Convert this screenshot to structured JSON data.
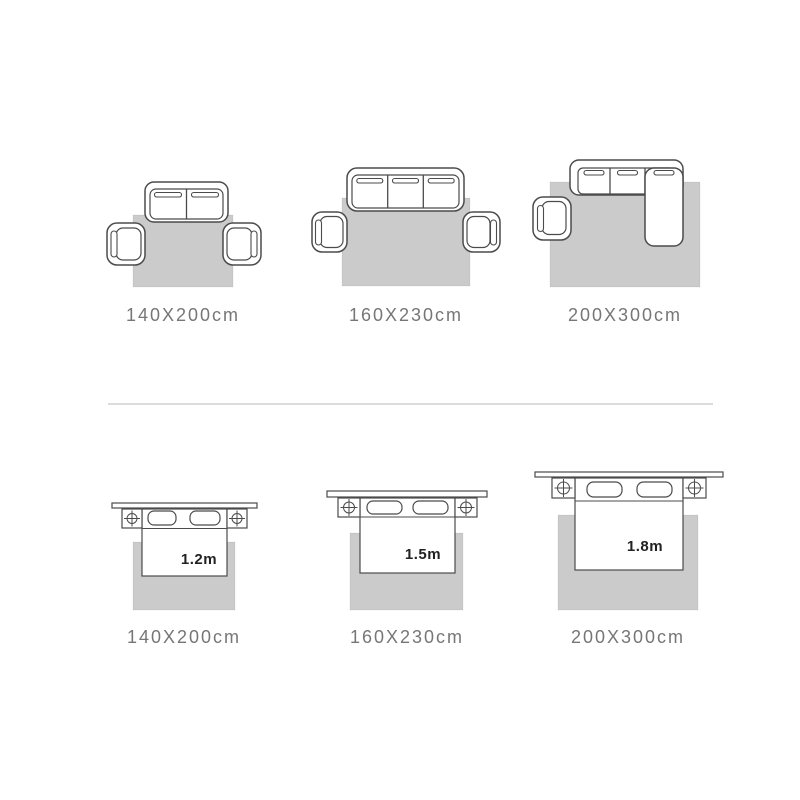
{
  "colors": {
    "rug_fill": "#cbcbcb",
    "furniture_outline": "#4b4b4b",
    "label_text": "#767676",
    "bed_size_text": "#222222",
    "divider": "#dcdcdc",
    "background": "#ffffff"
  },
  "rows": [
    {
      "name": "living-room-rug-sizes",
      "figures": [
        {
          "furniture": "two-seat-sofa-with-two-armchairs",
          "rug_size": "140X200cm"
        },
        {
          "furniture": "three-seat-sofa-with-two-armchairs",
          "rug_size": "160X230cm"
        },
        {
          "furniture": "sectional-chaise-sofa-with-armchair",
          "rug_size": "200X300cm"
        }
      ]
    },
    {
      "name": "bedroom-rug-sizes",
      "figures": [
        {
          "furniture": "bed-with-two-nightstands",
          "bed_width": "1.2m",
          "rug_size": "140X200cm"
        },
        {
          "furniture": "bed-with-two-nightstands",
          "bed_width": "1.5m",
          "rug_size": "160X230cm"
        },
        {
          "furniture": "bed-with-two-nightstands",
          "bed_width": "1.8m",
          "rug_size": "200X300cm"
        }
      ]
    }
  ]
}
